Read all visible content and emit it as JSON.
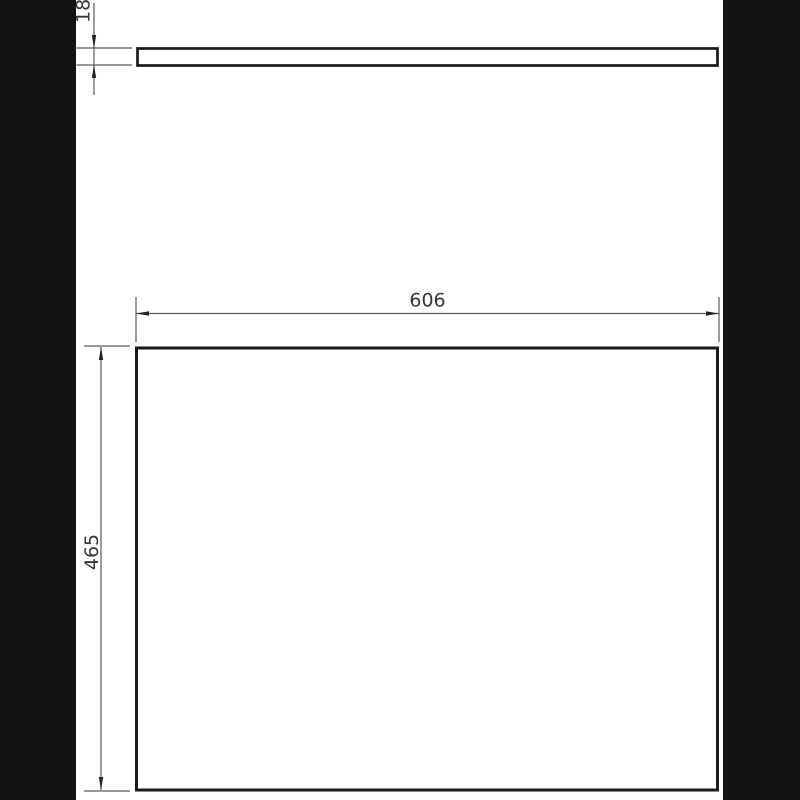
{
  "drawing": {
    "type": "technical-dimension-drawing",
    "views": {
      "side_view": "panel side profile (top view strip)",
      "front_view": "panel front face (large rectangle)"
    },
    "dims": {
      "thickness": "18",
      "width": "606",
      "height": "465"
    },
    "colors": {
      "margin_background": "#121212",
      "page_background": "#ffffff",
      "object_line": "#1a1a1e",
      "dimension_line": "#5a5a60",
      "dimension_text": "#35353c"
    }
  }
}
